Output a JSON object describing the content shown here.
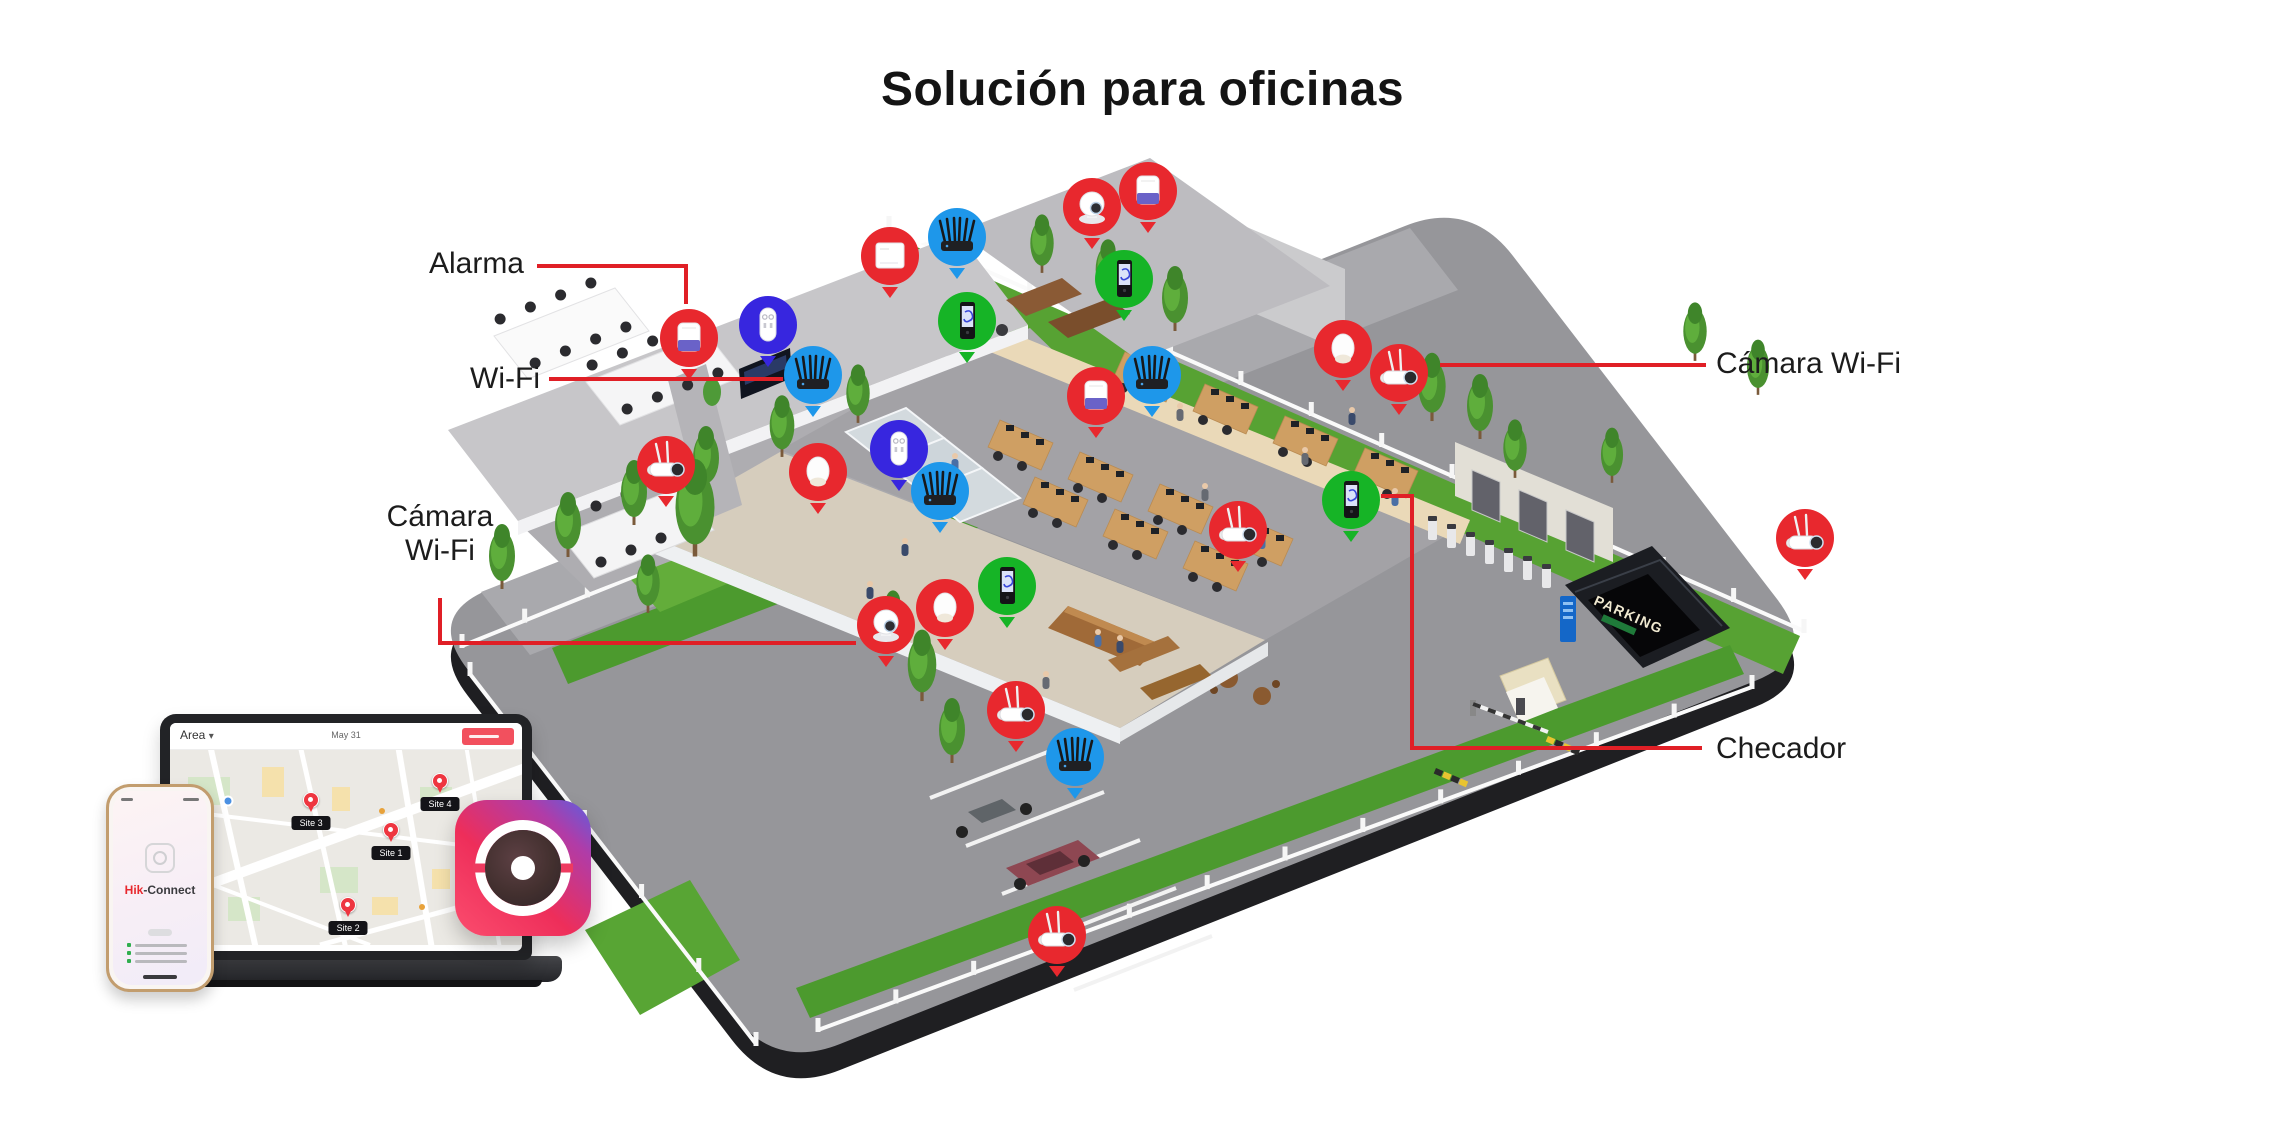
{
  "title": "Solución para oficinas",
  "callouts": {
    "alarma": {
      "label": "Alarma"
    },
    "wifi": {
      "label": "Wi-Fi"
    },
    "camara_wifi_left": {
      "line1": "Cámara",
      "line2": "Wi-Fi"
    },
    "camara_wifi_right": {
      "label": "Cámara Wi-Fi"
    },
    "checador": {
      "label": "Checador"
    }
  },
  "scene": {
    "parking_sign": "PARKING"
  },
  "devices": [
    {
      "type": "siren",
      "color": "red",
      "x": 689,
      "y": 338
    },
    {
      "type": "keypad",
      "color": "indigo",
      "x": 768,
      "y": 325
    },
    {
      "type": "router",
      "color": "azure",
      "x": 813,
      "y": 375
    },
    {
      "type": "hub",
      "color": "red",
      "x": 890,
      "y": 256
    },
    {
      "type": "router",
      "color": "azure",
      "x": 957,
      "y": 237
    },
    {
      "type": "checador",
      "color": "green",
      "x": 967,
      "y": 321
    },
    {
      "type": "ptz-camera",
      "color": "red",
      "x": 1092,
      "y": 207
    },
    {
      "type": "siren",
      "color": "red",
      "x": 1148,
      "y": 191
    },
    {
      "type": "checador",
      "color": "green",
      "x": 1124,
      "y": 279
    },
    {
      "type": "bullet-camera",
      "color": "red",
      "x": 666,
      "y": 465
    },
    {
      "type": "motion-sensor",
      "color": "red",
      "x": 818,
      "y": 472
    },
    {
      "type": "keypad",
      "color": "indigo",
      "x": 899,
      "y": 449
    },
    {
      "type": "router",
      "color": "azure",
      "x": 940,
      "y": 491
    },
    {
      "type": "ptz-camera",
      "color": "red",
      "x": 886,
      "y": 625
    },
    {
      "type": "motion-sensor",
      "color": "red",
      "x": 945,
      "y": 608
    },
    {
      "type": "checador",
      "color": "green",
      "x": 1007,
      "y": 586
    },
    {
      "type": "siren",
      "color": "red",
      "x": 1096,
      "y": 396
    },
    {
      "type": "router",
      "color": "azure",
      "x": 1152,
      "y": 375
    },
    {
      "type": "motion-sensor",
      "color": "red",
      "x": 1343,
      "y": 349
    },
    {
      "type": "bullet-camera",
      "color": "red",
      "x": 1399,
      "y": 373
    },
    {
      "type": "checador",
      "color": "green",
      "x": 1351,
      "y": 500
    },
    {
      "type": "bullet-camera",
      "color": "red",
      "x": 1016,
      "y": 710
    },
    {
      "type": "router",
      "color": "azure",
      "x": 1075,
      "y": 757
    },
    {
      "type": "bullet-camera",
      "color": "red",
      "x": 1057,
      "y": 935
    },
    {
      "type": "bullet-camera",
      "color": "red",
      "x": 1805,
      "y": 538
    },
    {
      "type": "bullet-camera",
      "color": "red",
      "x": 1238,
      "y": 530
    }
  ],
  "laptop": {
    "area_label": "Area",
    "date_label": "May 31",
    "sites": [
      {
        "name": "Site 3",
        "x_pct": 40.1,
        "y_pct": 32.1
      },
      {
        "name": "Site 4",
        "x_pct": 76.7,
        "y_pct": 22.4
      },
      {
        "name": "Site 1",
        "x_pct": 62.8,
        "y_pct": 47.4
      },
      {
        "name": "Site 2",
        "x_pct": 50.6,
        "y_pct": 85.7
      }
    ]
  },
  "phone": {
    "brand_red": "Hik",
    "brand_dark": "-Connect"
  },
  "icons": {
    "caret_down": "▾"
  },
  "colors": {
    "accent_red": "#e01f26",
    "marker_red": "#e8282e",
    "marker_azure": "#1e97ea",
    "marker_indigo": "#3726df",
    "marker_green": "#16b426"
  }
}
